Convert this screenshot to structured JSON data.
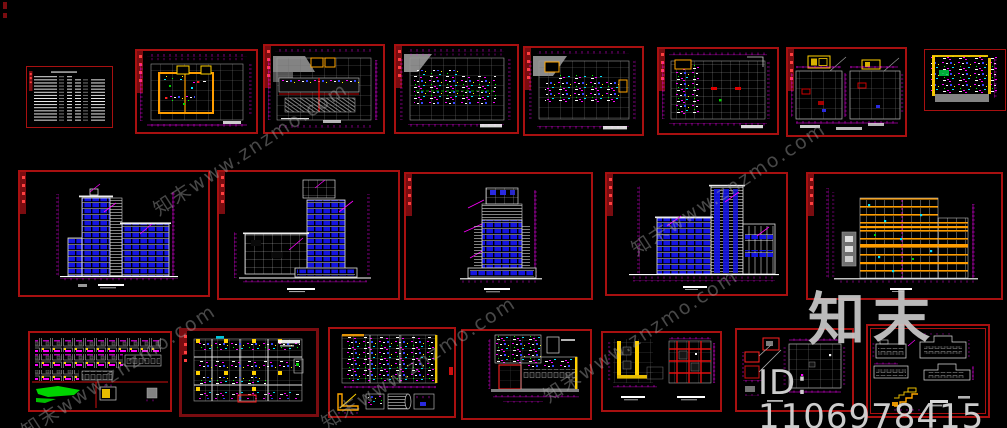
{
  "canvas": {
    "width": 1007,
    "height": 428,
    "background": "#000000",
    "description": "CAD model-space preview: hotel building drawing set (plans, elevations, sections, details) on black background"
  },
  "watermark": {
    "diagonal_text": "知末www.znzmo.com",
    "brand_text": "知末",
    "id_text": "ID: 1106978415"
  },
  "colors": {
    "bg": "#000000",
    "sheet-border": "#a81010",
    "sheet-border-dark": "#7a0c10",
    "dim-magenta": "#ff00ff",
    "window-blue": "#1414e0",
    "wall-orange": "#ff9d00",
    "accent-yellow": "#ffd000",
    "detail-green": "#00d400",
    "detail-cyan": "#00e5ff",
    "detail-red": "#ff2020",
    "grid-gray": "#6f6f6f",
    "line-white": "#e8e8e8",
    "watermark-gray": "#bdbdbd"
  },
  "sheets": [
    {
      "id": "general-notes",
      "kind": "text-sheet"
    },
    {
      "id": "floor-plan-1",
      "kind": "plan"
    },
    {
      "id": "floor-plan-2",
      "kind": "plan"
    },
    {
      "id": "floor-plan-3",
      "kind": "plan"
    },
    {
      "id": "floor-plan-4",
      "kind": "plan"
    },
    {
      "id": "floor-plan-5",
      "kind": "plan"
    },
    {
      "id": "roof-plans",
      "kind": "plan-pair"
    },
    {
      "id": "color-block-plan",
      "kind": "plan"
    },
    {
      "id": "elevation-1",
      "kind": "elevation"
    },
    {
      "id": "elevation-2",
      "kind": "elevation"
    },
    {
      "id": "elevation-3",
      "kind": "elevation"
    },
    {
      "id": "elevation-4",
      "kind": "elevation"
    },
    {
      "id": "building-section",
      "kind": "section"
    },
    {
      "id": "door-window-details",
      "kind": "details"
    },
    {
      "id": "unit-plan-detail",
      "kind": "plan"
    },
    {
      "id": "plan-detail-a",
      "kind": "details"
    },
    {
      "id": "plan-detail-b",
      "kind": "details"
    },
    {
      "id": "core-details",
      "kind": "details"
    },
    {
      "id": "node-details",
      "kind": "details"
    },
    {
      "id": "small-elevations",
      "kind": "details"
    }
  ]
}
